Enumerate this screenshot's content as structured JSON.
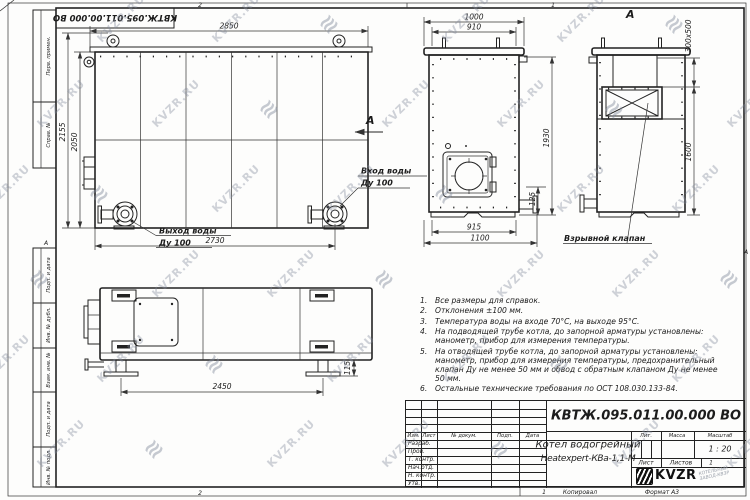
{
  "watermark": {
    "text": "KVZR.RU"
  },
  "sheet": {
    "stamp": "КВТЖ.095.011.00.000 ВО",
    "zone_top_left": "2",
    "zone_top_right": "1",
    "zone_bottom_left": "2",
    "zone_bottom_right": "1",
    "zone_left": "А",
    "zone_right": "А",
    "footer_copied": "Копировал",
    "footer_format": "Формат А3"
  },
  "strips": {
    "items": [
      "Перв. примен.",
      "Справ. №",
      "Подп. и дата",
      "Инв. № дубл.",
      "Взам. инв. №",
      "Подп. и дата",
      "Инв. № подл."
    ]
  },
  "front": {
    "dim_top": "2850",
    "dim_h_outer": "2155",
    "dim_h_inner": "2050",
    "dim_bottom": "2730",
    "outlet": "Выход воды",
    "outlet_dn": "Ду 100",
    "inlet": "Вход воды",
    "inlet_dn": "Ду 100",
    "arrow": "A"
  },
  "side": {
    "dim_top": "1000",
    "dim_top_inner": "910",
    "dim_height": "1930",
    "dim_stub": "125",
    "dim_bottom_inner": "915",
    "dim_bottom": "1100"
  },
  "viewa": {
    "label": "A",
    "dim_flue": "300x500",
    "dim_height": "1600",
    "callout": "Взрывной клапан"
  },
  "bottom": {
    "dim_span": "2450",
    "dim_foot": "115"
  },
  "notes": {
    "items": [
      {
        "num": "1.",
        "text": "Все размеры для справок."
      },
      {
        "num": "2.",
        "text": "Отклонения ±100 мм."
      },
      {
        "num": "3.",
        "text": "Температура воды на входе 70°С, на выходе 95°С."
      },
      {
        "num": "4.",
        "text": "На подводящей трубе котла, до запорной арматуры установлены: манометр, прибор для измерения температуры."
      },
      {
        "num": "5.",
        "text": "На отводящей трубе котла, до запорной арматуры установлены: манометр, прибор для измерения температуры, предохранительный клапан Ду не менее 50 мм и обвод с обратным клапаном Ду не менее 50 мм."
      },
      {
        "num": "6.",
        "text": "Остальные технические требования по ОСТ 108.030.133-84."
      }
    ]
  },
  "title_block": {
    "designation": "КВТЖ.095.011.00.000 ВО",
    "name_line1": "Котел водогрейный",
    "name_line2": "Heatexpert-КВа-1,1-М",
    "header": {
      "izm": "Изм.",
      "list": "Лист",
      "doc": "№ докум.",
      "podp": "Подп.",
      "data": "Дата"
    },
    "rows": [
      "Разраб.",
      "Пров.",
      "Т. контр.",
      "Нач.отд.",
      "Н. контр.",
      "Утв."
    ],
    "lit": "Лит.",
    "mass": "Масса",
    "scale_label": "Масштаб",
    "scale": "1 : 20",
    "sheet_label": "Лист",
    "sheets_label": "Листов",
    "sheets_value": "1",
    "logo": "KVZR",
    "org_line1": "КОТЕЛЬНЫЙ",
    "org_line2": "ЗАВОД-КВЗР"
  }
}
